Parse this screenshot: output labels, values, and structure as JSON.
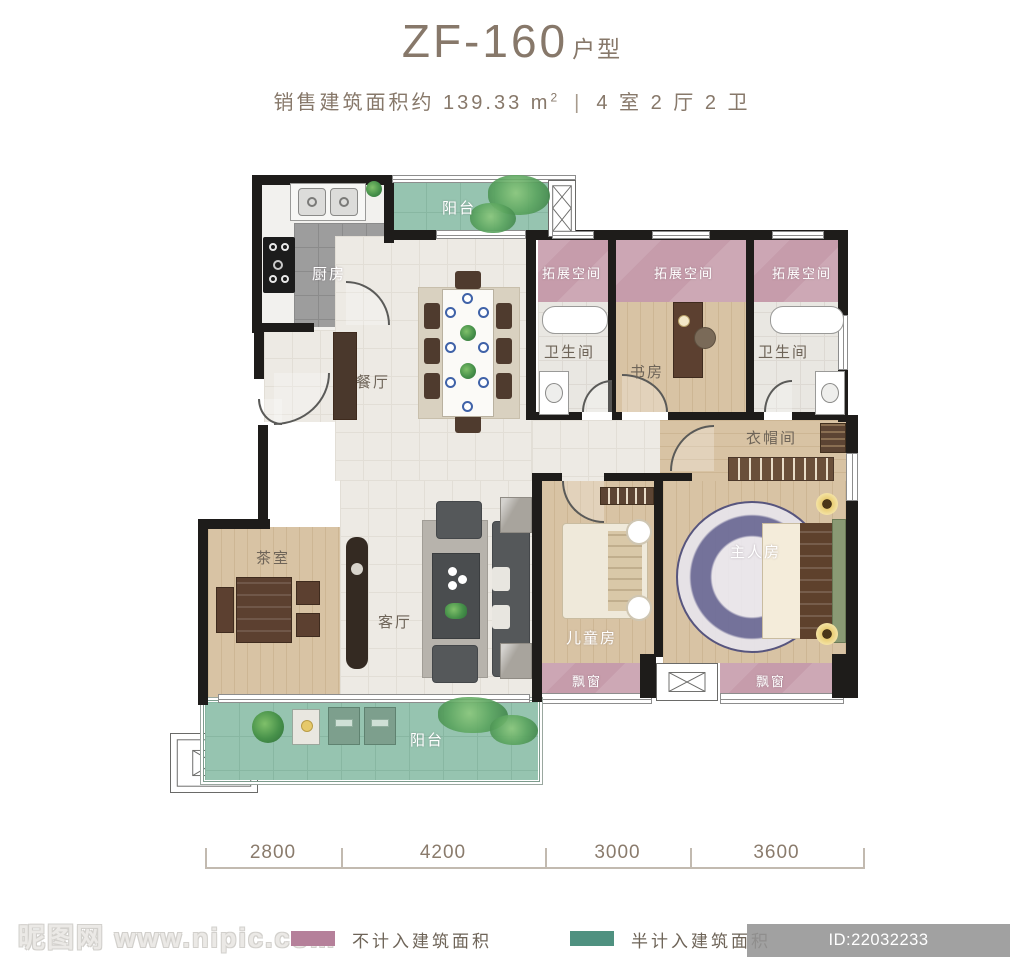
{
  "header": {
    "title": "ZF-160",
    "title_suffix": "户型",
    "area_text": "销售建筑面积约 139.33 m",
    "area_sup": "2",
    "divider": "|",
    "layout_text": "4 室 2 厅 2 卫"
  },
  "plan": {
    "rooms": {
      "kitchen": "厨房",
      "balcony_top": "阳台",
      "dining": "餐厅",
      "expansion_1": "拓展空间",
      "expansion_2": "拓展空间",
      "expansion_3": "拓展空间",
      "bathroom_left": "卫生间",
      "study": "书房",
      "bathroom_right": "卫生间",
      "cloakroom": "衣帽间",
      "master_bedroom": "主人房",
      "kids_room": "儿童房",
      "living": "客厅",
      "tea_room": "茶室",
      "bay_window_left": "飘窗",
      "bay_window_right": "飘窗",
      "balcony_bottom": "阳台"
    },
    "colors": {
      "excluded_area_pink": "#c69cab",
      "half_counted_teal": "#96c4b0",
      "wall_black": "#1e1c1a",
      "text_brown": "#87786a"
    }
  },
  "dimensions": {
    "segments": [
      "2800",
      "4200",
      "3000",
      "3600"
    ]
  },
  "legend": {
    "items": [
      {
        "label": "不计入建筑面积",
        "color": "#b5809a"
      },
      {
        "label": "半计入建筑面积",
        "color": "#4f9180"
      }
    ]
  },
  "watermark": {
    "site_name": "昵图网",
    "site_url": "www.nipic.com",
    "id_text": "ID:22032233 NO:20231020105910601107"
  }
}
